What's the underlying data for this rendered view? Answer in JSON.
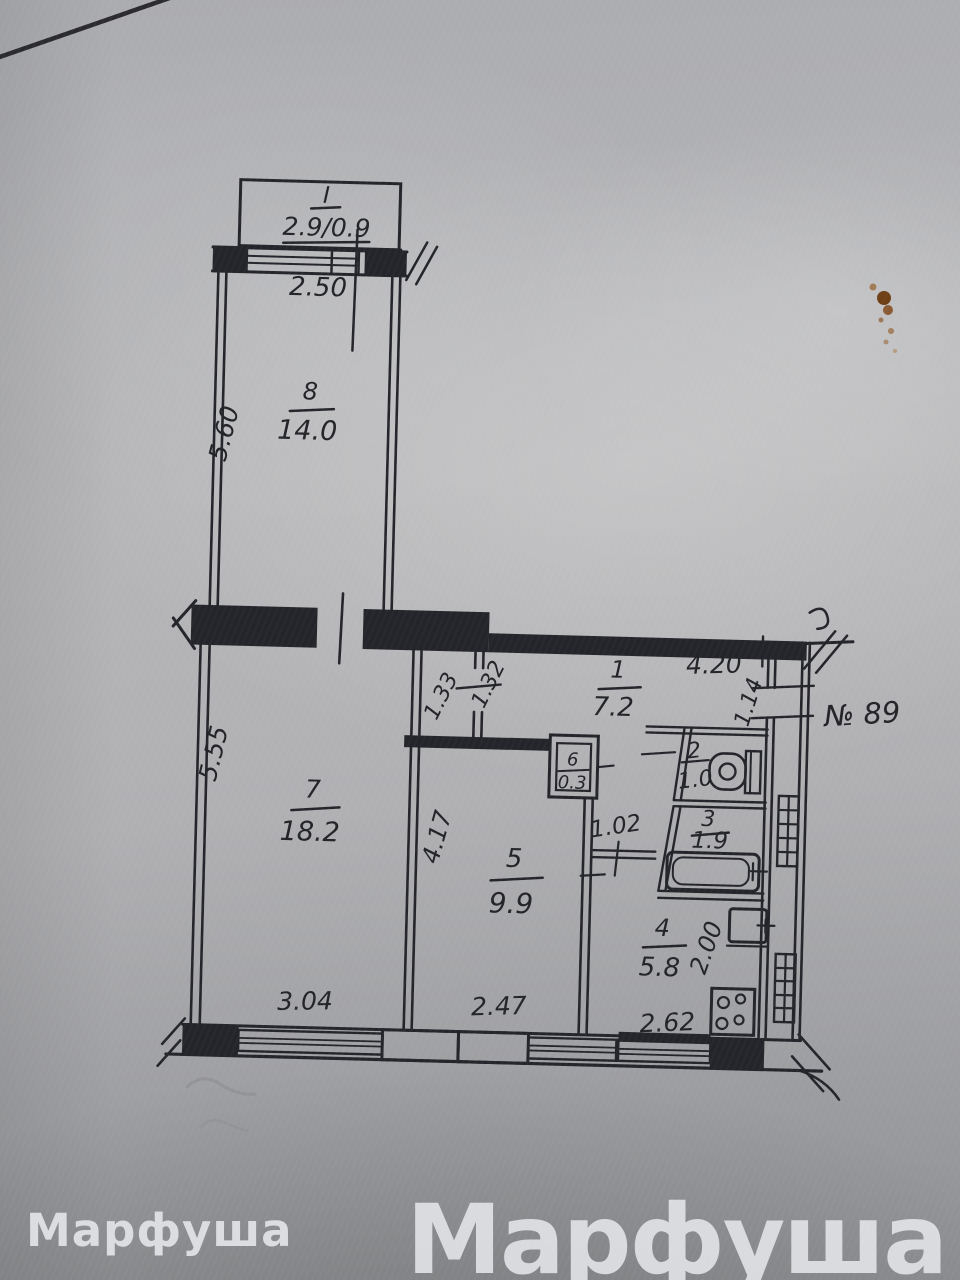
{
  "plan": {
    "balcony": {
      "index": "I",
      "size": "2.9/0.9",
      "width": "2.50"
    },
    "rooms": {
      "r1": {
        "number": "1",
        "area": "7.2"
      },
      "r2": {
        "number": "2",
        "area": "1.0"
      },
      "r3": {
        "number": "3",
        "area": "1.9"
      },
      "r4": {
        "number": "4",
        "area": "5.8"
      },
      "r5": {
        "number": "5",
        "area": "9.9"
      },
      "r6": {
        "number": "6",
        "area": "0.3"
      },
      "r7": {
        "number": "7",
        "area": "18.2"
      },
      "r8": {
        "number": "8",
        "area": "14.0"
      }
    },
    "dimensions": {
      "room8_side": "5.60",
      "room7_side": "5.55",
      "room7_bottom": "3.04",
      "room5_side": "4.17",
      "room5_bottom": "2.47",
      "hall_top": "4.20",
      "entry_door": "1.14",
      "corridor_left": "1.33",
      "corridor_right": "1.32",
      "lobby_width": "1.02",
      "kitchen_inner": "2.00",
      "kitchen_bottom": "2.62"
    },
    "apartment_label": "№ 89"
  },
  "watermark": {
    "small": "Марфуша",
    "large": "Марфуша"
  }
}
